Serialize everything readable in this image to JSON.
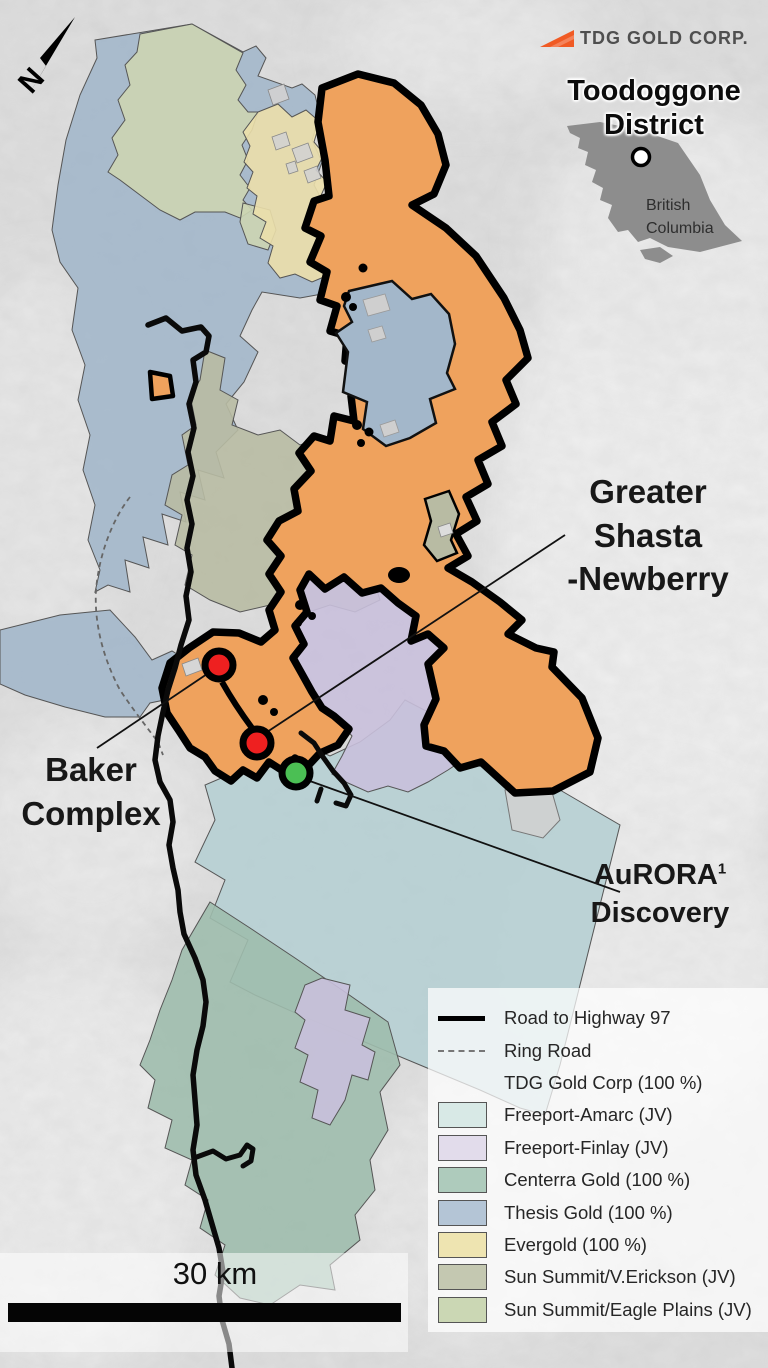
{
  "header": {
    "logo_label": "TDG GOLD CORP.",
    "title_line1": "Toodoggone",
    "title_line2": "District",
    "inset": {
      "region_line1": "British",
      "region_line2": "Columbia"
    }
  },
  "compass": {
    "label": "N"
  },
  "map_labels": {
    "greater_shasta": {
      "line1": "Greater",
      "line2": "Shasta",
      "line3": "-Newberry"
    },
    "baker": {
      "line1": "Baker",
      "line2": "Complex"
    },
    "aurora": {
      "name": "AuRORA",
      "superscript": "1",
      "line2": "Discovery"
    }
  },
  "scale_bar": {
    "label": "30 km"
  },
  "legend": {
    "items": [
      {
        "label": "Road to Highway 97",
        "swatch": "line-solid"
      },
      {
        "label": "Ring Road",
        "swatch": "line-dashed"
      },
      {
        "label": "TDG Gold Corp (100 %)",
        "swatch": "none"
      },
      {
        "label": "Freeport-Amarc (JV)",
        "swatch": "fill",
        "color": "#d8e9e6"
      },
      {
        "label": "Freeport-Finlay (JV)",
        "swatch": "fill",
        "color": "#e2dceb"
      },
      {
        "label": "Centerra Gold (100 %)",
        "swatch": "fill",
        "color": "#aecbbc"
      },
      {
        "label": "Thesis Gold (100 %)",
        "swatch": "fill",
        "color": "#b4c5d6"
      },
      {
        "label": "Evergold (100 %)",
        "swatch": "fill",
        "color": "#eee4b1"
      },
      {
        "label": "Sun Summit/V.Erickson (JV)",
        "swatch": "fill",
        "color": "#c4c8b1"
      },
      {
        "label": "Sun Summit/Eagle Plains (JV)",
        "swatch": "fill",
        "color": "#cbd7b4"
      }
    ]
  },
  "colors": {
    "brand_orange": "#f05a24",
    "tdg_claim": "#efa25d",
    "thesis_claim": "#a3b7ca",
    "amarc_claim": "#b6cfd3",
    "finlay_claim": "#c9c0dc",
    "centerra_claim": "#9ebcad",
    "evergold_claim": "#ebdfab",
    "verickson_claim": "#b8bba3",
    "eagleplains_claim": "#ccd5b2",
    "marker_red": "#ee2020",
    "marker_green": "#4bbf54",
    "bc_inset_gray": "#8d8d8d"
  },
  "markers": [
    {
      "name": "baker-complex-deposit",
      "color_key": "red"
    },
    {
      "name": "greater-shasta-newberry-deposit",
      "color_key": "red"
    },
    {
      "name": "aurora-discovery",
      "color_key": "green"
    }
  ]
}
